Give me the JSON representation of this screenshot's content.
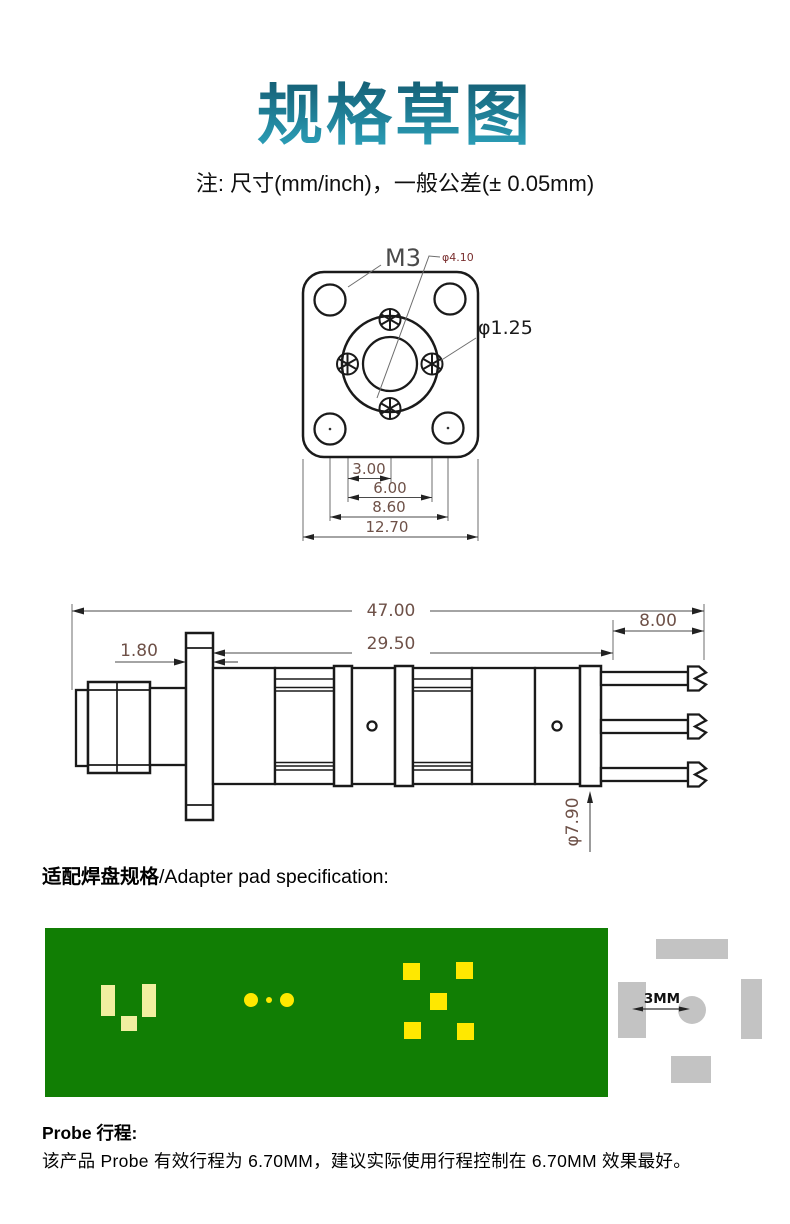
{
  "title": "规格草图",
  "note": "注: 尺寸(mm/inch)，一般公差(± 0.05mm)",
  "flange_view": {
    "label_m3": "M3",
    "label_bore_dia": "φ4.10",
    "label_pin_dia": "φ1.25",
    "dim_pin_offset": "3.00",
    "dim_pin_span": "6.00",
    "dim_hole_span": "8.60",
    "dim_flange_width": "12.70"
  },
  "side_view": {
    "dim_total_length": "47.00",
    "dim_body_length": "29.50",
    "dim_tail_length": "8.00",
    "dim_flange_thickness": "1.80",
    "dim_body_dia": "φ7.90"
  },
  "adapter_section": {
    "heading_zh": "适配焊盘规格",
    "heading_en": "/Adapter pad specification:"
  },
  "pad_diagram": {
    "dim_label": "3MM"
  },
  "probe_section": {
    "heading": "Probe 行程:",
    "description": "该产品 Probe 有效行程为 6.70MM，建议实际使用行程控制在 6.70MM 效果最好。"
  },
  "colors": {
    "title_gradient_top": "#0e4d63",
    "title_gradient_bottom": "#2fa9c2",
    "pcb_green": "#117e04",
    "pad_yellow_bright": "#ffe800",
    "pad_yellow_pale": "#f2efa0",
    "pad_gray": "#c3c3c3",
    "dim_text": "#6e5148",
    "line_black": "#1a1a1a"
  }
}
